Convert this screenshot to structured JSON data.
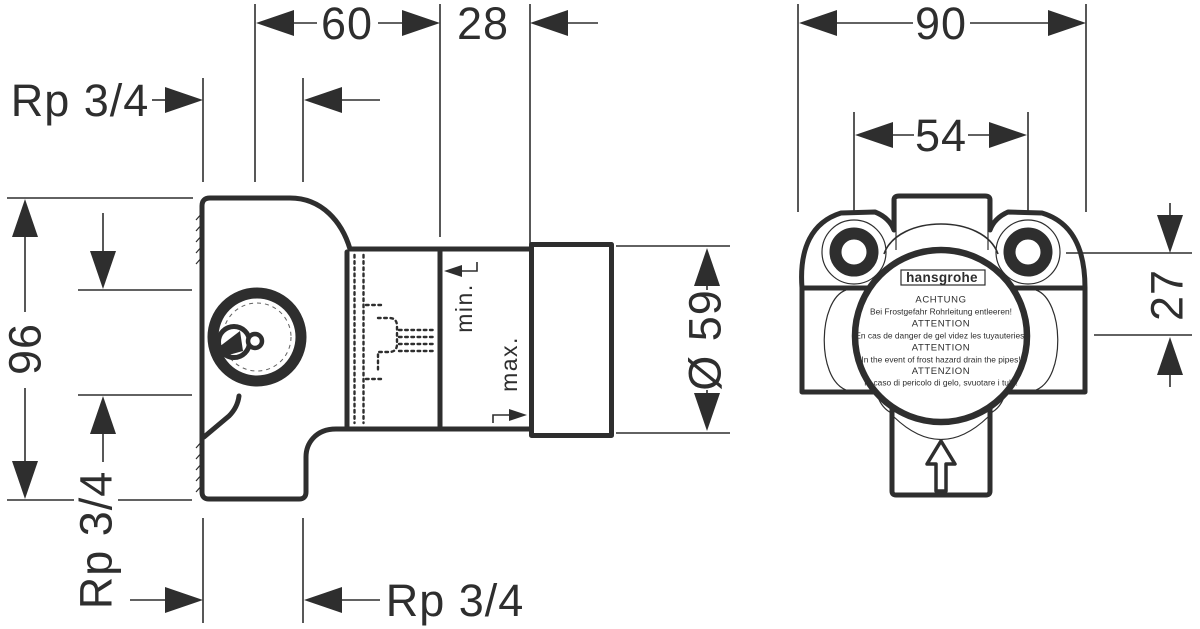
{
  "drawing": {
    "left_view": {
      "dim_depth": "60",
      "dim_depth2": "28",
      "dim_height": "96",
      "diameter": "Ø 59",
      "thread_top": "Rp 3/4",
      "thread_side": "Rp 3/4",
      "thread_bottom": "Rp 3/4",
      "min_label": "min.",
      "max_label": "max."
    },
    "right_view": {
      "dim_width": "90",
      "dim_hole_spacing": "54",
      "dim_axis_offset": "27",
      "logo": "hansgrohe",
      "warnings": [
        "ACHTUNG",
        "Bei Frostgefahr Rohrleitung entleeren!",
        "ATTENTION",
        "En cas de danger de gel videz les tuyauteries!",
        "ATTENTION",
        "In the event of frost hazard drain the pipes!",
        "ATTENZION",
        "In caso di pericolo di gelo, svuotare i tubi!"
      ]
    },
    "colors": {
      "line": "#2e2e2e",
      "background": "#ffffff"
    }
  }
}
